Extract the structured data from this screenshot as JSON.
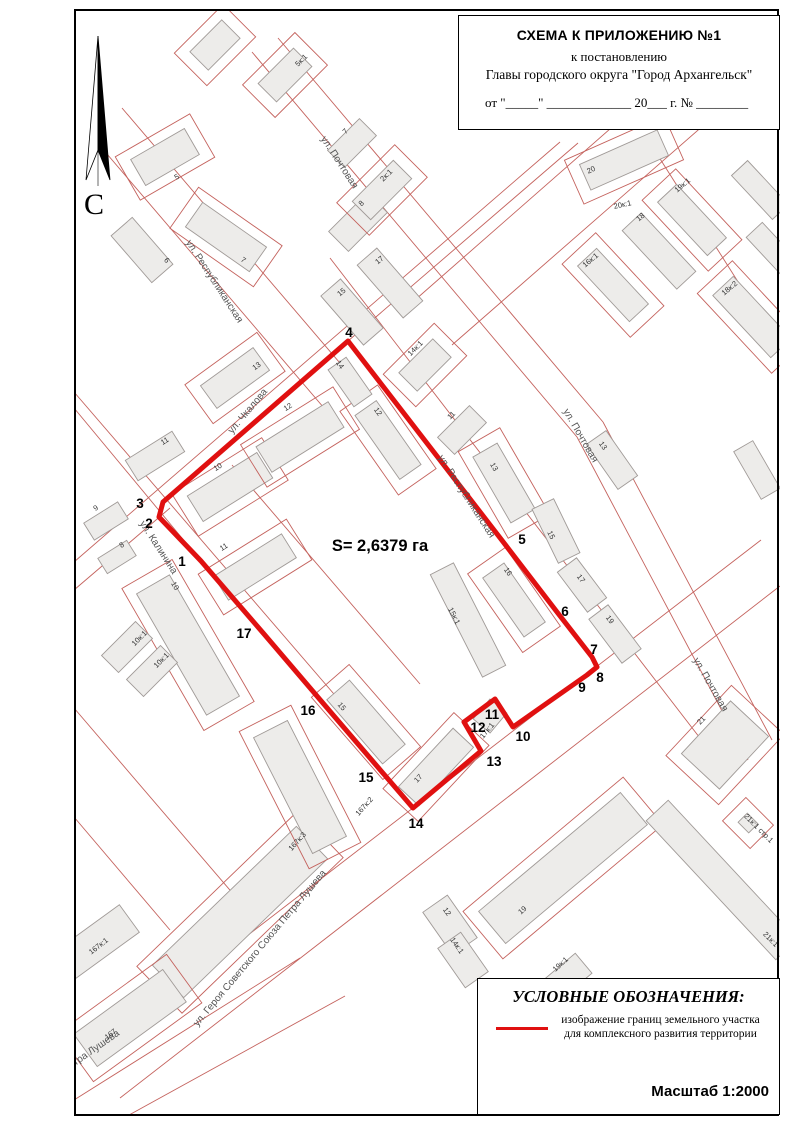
{
  "title_block": {
    "line1": "СХЕМА К ПРИЛОЖЕНИЮ №1",
    "line2": "к постановлению",
    "line3": "Главы городского округа \"Город Архангельск\"",
    "line4": "от \"_____\" _____________ 20___ г. № ________"
  },
  "north": {
    "label": "С"
  },
  "legend": {
    "title": "УСЛОВНЫЕ ОБОЗНАЧЕНИЯ:",
    "desc1": "изображение границ земельного участка",
    "desc2": "для комплексного развития территории",
    "scale": "Масштаб 1:2000",
    "line_color": "#e01010"
  },
  "map": {
    "colors": {
      "boundary": "#e01010",
      "cadastral_line": "#c4625d",
      "building_fill": "#edecea",
      "building_stroke": "#a09a97",
      "street_text": "#555555",
      "label_text": "#333333"
    },
    "area_label": {
      "text": "S= 2,6379 га",
      "x": 380,
      "y": 551
    },
    "parcel": {
      "vertices": [
        {
          "n": "1",
          "x": 201,
          "y": 561,
          "lx": 182,
          "ly": 562
        },
        {
          "n": "2",
          "x": 159,
          "y": 517,
          "lx": 149,
          "ly": 524
        },
        {
          "n": "3",
          "x": 163,
          "y": 502,
          "lx": 140,
          "ly": 504
        },
        {
          "n": "4",
          "x": 348,
          "y": 341,
          "lx": 349,
          "ly": 333
        },
        {
          "n": "5",
          "x": 494,
          "y": 530,
          "lx": 522,
          "ly": 540
        },
        {
          "n": "6",
          "x": 557,
          "y": 612,
          "lx": 565,
          "ly": 612
        },
        {
          "n": "7",
          "x": 592,
          "y": 657,
          "lx": 594,
          "ly": 650
        },
        {
          "n": "8",
          "x": 597,
          "y": 667,
          "lx": 600,
          "ly": 678
        },
        {
          "n": "9",
          "x": 587,
          "y": 675,
          "lx": 582,
          "ly": 688
        },
        {
          "n": "10",
          "x": 513,
          "y": 727,
          "lx": 523,
          "ly": 737
        },
        {
          "n": "11",
          "x": 495,
          "y": 699,
          "lx": 492,
          "ly": 715
        },
        {
          "n": "12",
          "x": 464,
          "y": 722,
          "lx": 478,
          "ly": 728
        },
        {
          "n": "13",
          "x": 481,
          "y": 751,
          "lx": 494,
          "ly": 762
        },
        {
          "n": "14",
          "x": 413,
          "y": 808,
          "lx": 416,
          "ly": 824
        },
        {
          "n": "15",
          "x": 382,
          "y": 772,
          "lx": 366,
          "ly": 778
        },
        {
          "n": "16",
          "x": 334,
          "y": 716,
          "lx": 308,
          "ly": 711
        },
        {
          "n": "17",
          "x": 264,
          "y": 634,
          "lx": 244,
          "ly": 634
        }
      ]
    },
    "streets": [
      {
        "text": "ул. Чкалова",
        "x": 250,
        "y": 413,
        "r": -50
      },
      {
        "text": "ул. Республиканская",
        "x": 212,
        "y": 283,
        "r": 57
      },
      {
        "text": "ул. Республиканская",
        "x": 464,
        "y": 498,
        "r": 57
      },
      {
        "text": "ул. Калинина",
        "x": 156,
        "y": 549,
        "r": 57
      },
      {
        "text": "ул. Почтовая",
        "x": 337,
        "y": 164,
        "r": 57
      },
      {
        "text": "ул. Почтовая",
        "x": 578,
        "y": 437,
        "r": 60
      },
      {
        "text": "ул. Почтовая",
        "x": 708,
        "y": 686,
        "r": 60
      },
      {
        "text": "ул. Героя Советского Союза Петра Лушева",
        "x": 262,
        "y": 950,
        "r": -50
      },
      {
        "text": "ул. Героя Советского Союза Петра Лушева",
        "x": 38,
        "y": 1092,
        "r": -35
      }
    ],
    "building_labels": [
      {
        "t": "5к:1",
        "x": 303,
        "y": 62,
        "r": -45
      },
      {
        "t": "7",
        "x": 347,
        "y": 133,
        "r": -45
      },
      {
        "t": "5",
        "x": 178,
        "y": 179,
        "r": -30
      },
      {
        "t": "6",
        "x": 165,
        "y": 262,
        "r": 49
      },
      {
        "t": "7",
        "x": 242,
        "y": 262,
        "r": 35
      },
      {
        "t": "8",
        "x": 363,
        "y": 205,
        "r": -45
      },
      {
        "t": "2к:1",
        "x": 388,
        "y": 177,
        "r": -45
      },
      {
        "t": "17",
        "x": 381,
        "y": 262,
        "r": -40
      },
      {
        "t": "15",
        "x": 343,
        "y": 294,
        "r": -40
      },
      {
        "t": "13",
        "x": 258,
        "y": 368,
        "r": -36
      },
      {
        "t": "11",
        "x": 166,
        "y": 443,
        "r": -32
      },
      {
        "t": "9",
        "x": 97,
        "y": 510,
        "r": -32
      },
      {
        "t": "8",
        "x": 123,
        "y": 547,
        "r": -32
      },
      {
        "t": "10",
        "x": 219,
        "y": 469,
        "r": -32
      },
      {
        "t": "11",
        "x": 225,
        "y": 549,
        "r": -32
      },
      {
        "t": "12",
        "x": 289,
        "y": 409,
        "r": -32
      },
      {
        "t": "12",
        "x": 376,
        "y": 413,
        "r": 55
      },
      {
        "t": "14",
        "x": 338,
        "y": 366,
        "r": 55
      },
      {
        "t": "14к:1",
        "x": 417,
        "y": 350,
        "r": -45
      },
      {
        "t": "11",
        "x": 453,
        "y": 417,
        "r": -45
      },
      {
        "t": "13",
        "x": 492,
        "y": 468,
        "r": 60
      },
      {
        "t": "15",
        "x": 549,
        "y": 536,
        "r": 64
      },
      {
        "t": "16",
        "x": 506,
        "y": 573,
        "r": 55
      },
      {
        "t": "15к:1",
        "x": 452,
        "y": 617,
        "r": 63
      },
      {
        "t": "17",
        "x": 579,
        "y": 580,
        "r": 53
      },
      {
        "t": "19",
        "x": 608,
        "y": 621,
        "r": 53
      },
      {
        "t": "13",
        "x": 601,
        "y": 447,
        "r": 55
      },
      {
        "t": "20",
        "x": 592,
        "y": 172,
        "r": -24
      },
      {
        "t": "20к:1",
        "x": 623,
        "y": 207,
        "r": -12
      },
      {
        "t": "19к:1",
        "x": 684,
        "y": 187,
        "r": -40
      },
      {
        "t": "18",
        "x": 642,
        "y": 219,
        "r": -40
      },
      {
        "t": "16к:1",
        "x": 592,
        "y": 262,
        "r": -40
      },
      {
        "t": "18к:2",
        "x": 731,
        "y": 290,
        "r": -40
      },
      {
        "t": "10",
        "x": 173,
        "y": 587,
        "r": 60
      },
      {
        "t": "10к:1",
        "x": 141,
        "y": 640,
        "r": -45
      },
      {
        "t": "10к:1",
        "x": 163,
        "y": 662,
        "r": -45
      },
      {
        "t": "15",
        "x": 340,
        "y": 708,
        "r": 49
      },
      {
        "t": "17",
        "x": 420,
        "y": 780,
        "r": -47
      },
      {
        "t": "17к:1",
        "x": 489,
        "y": 732,
        "r": -50
      },
      {
        "t": "167к:2",
        "x": 366,
        "y": 808,
        "r": -48
      },
      {
        "t": "167к:3",
        "x": 299,
        "y": 843,
        "r": -48
      },
      {
        "t": "167",
        "x": 112,
        "y": 1036,
        "r": -38
      },
      {
        "t": "167к:1",
        "x": 100,
        "y": 948,
        "r": -38
      },
      {
        "t": "12",
        "x": 445,
        "y": 913,
        "r": 55
      },
      {
        "t": "14к:1",
        "x": 455,
        "y": 947,
        "r": 55
      },
      {
        "t": "19",
        "x": 524,
        "y": 912,
        "r": -42
      },
      {
        "t": "19к:1",
        "x": 562,
        "y": 966,
        "r": -42
      },
      {
        "t": "21",
        "x": 703,
        "y": 722,
        "r": -47
      },
      {
        "t": "21к:1",
        "x": 769,
        "y": 941,
        "r": 45
      },
      {
        "t": "21к:1 стр.1",
        "x": 757,
        "y": 830,
        "r": 45
      }
    ],
    "buildings": [
      {
        "x": 230,
        "y": 487,
        "w": 82,
        "h": 30,
        "r": -32,
        "p": 1
      },
      {
        "x": 255,
        "y": 567,
        "w": 80,
        "h": 28,
        "r": -32,
        "p": 1
      },
      {
        "x": 300,
        "y": 437,
        "w": 85,
        "h": 30,
        "r": -32,
        "p": 1
      },
      {
        "x": 388,
        "y": 440,
        "w": 78,
        "h": 26,
        "r": 55,
        "p": 1
      },
      {
        "x": 350,
        "y": 382,
        "w": 45,
        "h": 22,
        "r": 55,
        "p": 0
      },
      {
        "x": 514,
        "y": 600,
        "w": 72,
        "h": 26,
        "r": 55,
        "p": 1
      },
      {
        "x": 468,
        "y": 620,
        "w": 115,
        "h": 26,
        "r": 63,
        "p": 0
      },
      {
        "x": 436,
        "y": 767,
        "w": 80,
        "h": 28,
        "r": -47,
        "p": 1
      },
      {
        "x": 366,
        "y": 722,
        "w": 85,
        "h": 30,
        "r": 49,
        "p": 1
      },
      {
        "x": 155,
        "y": 456,
        "w": 55,
        "h": 24,
        "r": -32,
        "p": 0
      },
      {
        "x": 106,
        "y": 521,
        "w": 40,
        "h": 20,
        "r": -32,
        "p": 0
      },
      {
        "x": 117,
        "y": 557,
        "w": 34,
        "h": 18,
        "r": -32,
        "p": 0
      },
      {
        "x": 188,
        "y": 645,
        "w": 140,
        "h": 38,
        "r": 60,
        "p": 1
      },
      {
        "x": 127,
        "y": 647,
        "w": 48,
        "h": 24,
        "r": -45,
        "p": 0
      },
      {
        "x": 152,
        "y": 671,
        "w": 48,
        "h": 24,
        "r": -45,
        "p": 0
      },
      {
        "x": 165,
        "y": 157,
        "w": 62,
        "h": 30,
        "r": -30,
        "p": 1
      },
      {
        "x": 142,
        "y": 250,
        "w": 62,
        "h": 28,
        "r": 49,
        "p": 0
      },
      {
        "x": 226,
        "y": 237,
        "w": 78,
        "h": 30,
        "r": 35,
        "p": 1
      },
      {
        "x": 358,
        "y": 222,
        "w": 55,
        "h": 28,
        "r": -45,
        "p": 0
      },
      {
        "x": 382,
        "y": 190,
        "w": 58,
        "h": 26,
        "r": -45,
        "p": 1
      },
      {
        "x": 235,
        "y": 378,
        "w": 65,
        "h": 28,
        "r": -36,
        "p": 1
      },
      {
        "x": 285,
        "y": 75,
        "w": 50,
        "h": 26,
        "r": -45,
        "p": 1
      },
      {
        "x": 352,
        "y": 143,
        "w": 45,
        "h": 24,
        "r": -45,
        "p": 0
      },
      {
        "x": 215,
        "y": 45,
        "w": 45,
        "h": 26,
        "r": -45,
        "p": 1
      },
      {
        "x": 390,
        "y": 283,
        "w": 70,
        "h": 26,
        "r": 49,
        "p": 0
      },
      {
        "x": 352,
        "y": 312,
        "w": 65,
        "h": 26,
        "r": 49,
        "p": 0
      },
      {
        "x": 425,
        "y": 365,
        "w": 48,
        "h": 26,
        "r": -45,
        "p": 1
      },
      {
        "x": 462,
        "y": 430,
        "w": 45,
        "h": 24,
        "r": -45,
        "p": 0
      },
      {
        "x": 504,
        "y": 483,
        "w": 76,
        "h": 28,
        "r": 60,
        "p": 1
      },
      {
        "x": 556,
        "y": 531,
        "w": 60,
        "h": 24,
        "r": 64,
        "p": 0
      },
      {
        "x": 582,
        "y": 585,
        "w": 50,
        "h": 24,
        "r": 53,
        "p": 0
      },
      {
        "x": 615,
        "y": 634,
        "w": 55,
        "h": 24,
        "r": 53,
        "p": 0
      },
      {
        "x": 612,
        "y": 460,
        "w": 55,
        "h": 24,
        "r": 55,
        "p": 0
      },
      {
        "x": 624,
        "y": 160,
        "w": 85,
        "h": 28,
        "r": -24,
        "p": 1
      },
      {
        "x": 692,
        "y": 220,
        "w": 73,
        "h": 26,
        "r": 47,
        "p": 1
      },
      {
        "x": 659,
        "y": 251,
        "w": 80,
        "h": 26,
        "r": 47,
        "p": 0
      },
      {
        "x": 613,
        "y": 285,
        "w": 76,
        "h": 26,
        "r": 47,
        "p": 1
      },
      {
        "x": 752,
        "y": 317,
        "w": 85,
        "h": 28,
        "r": 47,
        "p": 1
      },
      {
        "x": 240,
        "y": 912,
        "w": 200,
        "h": 45,
        "r": -44,
        "p": 1
      },
      {
        "x": 563,
        "y": 868,
        "w": 185,
        "h": 42,
        "r": -40,
        "p": 1
      },
      {
        "x": 450,
        "y": 925,
        "w": 52,
        "h": 30,
        "r": 55,
        "p": 0
      },
      {
        "x": 463,
        "y": 960,
        "w": 48,
        "h": 28,
        "r": 55,
        "p": 0
      },
      {
        "x": 566,
        "y": 978,
        "w": 46,
        "h": 26,
        "r": -40,
        "p": 0
      },
      {
        "x": 725,
        "y": 745,
        "w": 72,
        "h": 52,
        "r": -47,
        "p": 1
      },
      {
        "x": 722,
        "y": 880,
        "w": 190,
        "h": 30,
        "r": 47,
        "p": 0
      },
      {
        "x": 130,
        "y": 1018,
        "w": 110,
        "h": 40,
        "r": -36,
        "p": 1
      },
      {
        "x": 97,
        "y": 942,
        "w": 80,
        "h": 34,
        "r": -36,
        "p": 0
      },
      {
        "x": 300,
        "y": 787,
        "w": 130,
        "h": 38,
        "r": 63,
        "p": 1
      },
      {
        "x": 760,
        "y": 190,
        "w": 60,
        "h": 22,
        "r": 47,
        "p": 0
      },
      {
        "x": 773,
        "y": 250,
        "w": 55,
        "h": 22,
        "r": 47,
        "p": 0
      },
      {
        "x": 700,
        "y": 90,
        "w": 55,
        "h": 24,
        "r": -24,
        "p": 0
      },
      {
        "x": 757,
        "y": 470,
        "w": 55,
        "h": 22,
        "r": 60,
        "p": 0
      },
      {
        "x": 748,
        "y": 823,
        "w": 15,
        "h": 13,
        "r": 45,
        "p": 1
      },
      {
        "x": 490,
        "y": 716,
        "w": 26,
        "h": 22,
        "r": -50,
        "p": 0
      }
    ],
    "lines": [
      [
        74,
        562,
        560,
        142
      ],
      [
        74,
        590,
        170,
        508
      ],
      [
        348,
        341,
        578,
        143
      ],
      [
        100,
        1049,
        761,
        540
      ],
      [
        120,
        1098,
        780,
        586
      ],
      [
        74,
        1100,
        300,
        958
      ],
      [
        100,
        1131,
        345,
        996
      ],
      [
        415,
        300,
        700,
        50
      ],
      [
        452,
        345,
        760,
        76
      ],
      [
        74,
        392,
        352,
        715
      ],
      [
        74,
        408,
        201,
        561
      ],
      [
        95,
        140,
        330,
        415
      ],
      [
        122,
        108,
        357,
        383
      ],
      [
        330,
        258,
        703,
        742
      ],
      [
        252,
        52,
        577,
        437
      ],
      [
        577,
        437,
        748,
        760
      ],
      [
        278,
        38,
        603,
        422
      ],
      [
        603,
        422,
        772,
        740
      ],
      [
        650,
        143,
        780,
        348
      ],
      [
        232,
        465,
        420,
        684
      ],
      [
        74,
        708,
        235,
        896
      ],
      [
        74,
        817,
        170,
        930
      ]
    ]
  }
}
